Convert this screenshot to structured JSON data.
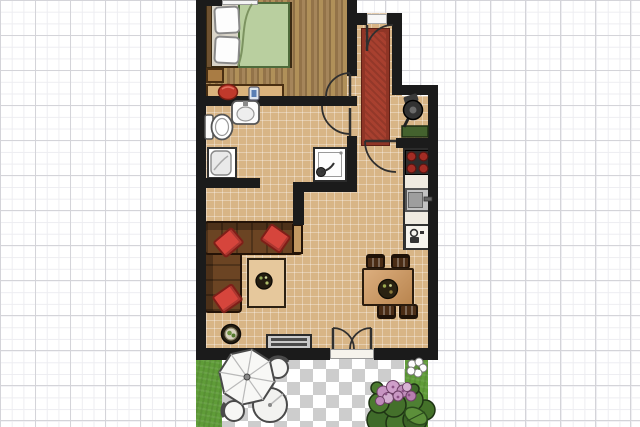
{
  "meta": {
    "description": "2D apartment floor plan rendered on graph paper",
    "canvas": {
      "width": 640,
      "height": 427
    }
  },
  "colors": {
    "wall": "#1b1b1b",
    "wood_floor": "#9c7b4d",
    "tile_floor": "#d8b586",
    "rug": "#a8402f",
    "duvet": "#b9cf9f",
    "sofa": "#6b4423",
    "pillow": "#d6453c",
    "burner": "#a32c24",
    "grass": "#5f9c38",
    "paving_light": "#ffffff",
    "paving_dark": "#cdcdcd",
    "foliage": "#4e8033",
    "blossom": "#c795c2"
  },
  "rooms": {
    "bedroom": {
      "label": "Bedroom"
    },
    "bathroom": {
      "label": "Bathroom"
    },
    "hallway": {
      "label": "Entrance hall"
    },
    "storage_niche": {
      "label": "Storage niche"
    },
    "kitchen": {
      "label": "Kitchen and dining area"
    },
    "living_room": {
      "label": "Living room"
    },
    "garden": {
      "label": "Garden patio"
    }
  },
  "doors": {
    "entry": {
      "label": "Entry door"
    },
    "bedroom": {
      "label": "Bedroom door"
    },
    "bathroom": {
      "label": "Bathroom door"
    },
    "kitchen": {
      "label": "Hall to kitchen door"
    },
    "garden": {
      "label": "French doors to garden"
    }
  },
  "furniture": {
    "bed": {
      "label": "Double bed with green duvet"
    },
    "nightstand": {
      "label": "Nightstand"
    },
    "dresser": {
      "label": "Dresser with decor"
    },
    "toilet": {
      "label": "Toilet"
    },
    "washbasin": {
      "label": "Washbasin"
    },
    "washing_machine": {
      "label": "Washing machine"
    },
    "shower": {
      "label": "Shower cabin"
    },
    "hall_rug": {
      "label": "Red runner rug"
    },
    "vacuum": {
      "label": "Vacuum cleaner in niche"
    },
    "counter": {
      "label": "Kitchen counter"
    },
    "stove": {
      "label": "Cooktop with four burners"
    },
    "kitchen_sink": {
      "label": "Kitchen sink"
    },
    "fridge": {
      "label": "Refrigerator"
    },
    "dining_table": {
      "label": "Dining table with bowl"
    },
    "dining_chair": {
      "label": "Dining chair"
    },
    "sofa": {
      "label": "Brown corner sofa"
    },
    "pillow": {
      "label": "Red throw pillow"
    },
    "coffee_table": {
      "label": "Coffee table with bowl"
    },
    "floor_plant": {
      "label": "Potted plant"
    },
    "tv_bench": {
      "label": "TV bench"
    },
    "umbrella": {
      "label": "Patio umbrella"
    },
    "patio_table": {
      "label": "Round patio table"
    },
    "patio_chair": {
      "label": "Patio chair"
    },
    "flower_bush": {
      "label": "Flowering shrub"
    },
    "white_flower": {
      "label": "White flower"
    }
  }
}
